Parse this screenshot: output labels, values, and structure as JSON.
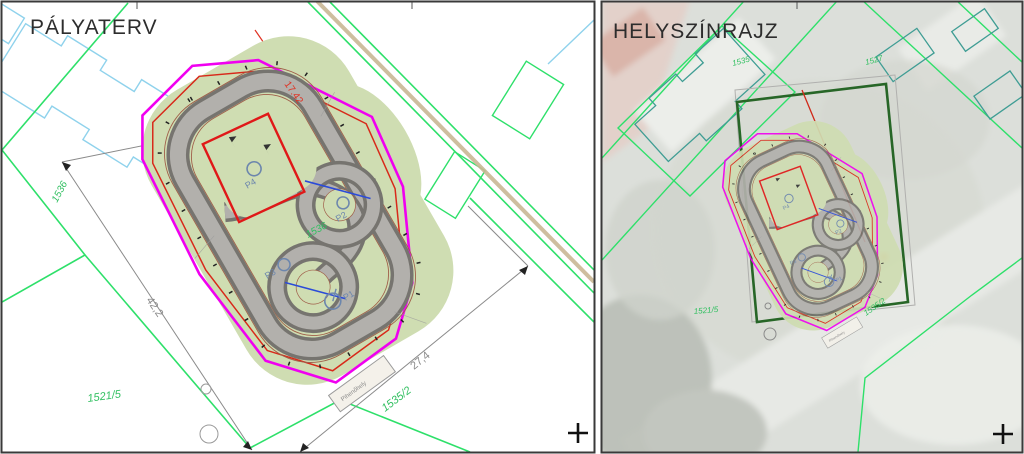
{
  "left_panel": {
    "title": "PÁLYATERV",
    "dim_17_42": "17.42",
    "dim_42_2": "42,2",
    "dim_27_4": "27,4",
    "parcel_1536_boundary": "1536",
    "parcel_1536_infield": "1536",
    "parcel_1521_5": "1521/5",
    "parcel_1535_2": "1535/2"
  },
  "track": {
    "p1": "P1",
    "p2": "P2",
    "p3": "P3",
    "p4": "P4",
    "rest_area_label": "Pihenőhely"
  },
  "right_panel": {
    "title": "HELYSZÍNRAJZ",
    "parcel_1535": "1535",
    "parcel_1527": "1527",
    "parcel_1521_5": "1521/5",
    "parcel_1535_2": "1535/2"
  },
  "colors": {
    "site_boundary_magenta": "#f000f0",
    "offset_red": "#d8291a",
    "cadastral_green": "#2ee06a",
    "building_cyan": "#8fd2ec",
    "building_teal": "#3f9d94",
    "track_gray": "#b2b0ac",
    "track_edge_gray": "#76746f",
    "infield_green": "#cfddb2",
    "contour_brown": "#a05f4a",
    "site_rect_dark_green": "#276627",
    "parcel_text_green": "#2fbf5f",
    "dimension_gray": "#8a8a8a",
    "point_label_blue": "#6c86ad"
  }
}
